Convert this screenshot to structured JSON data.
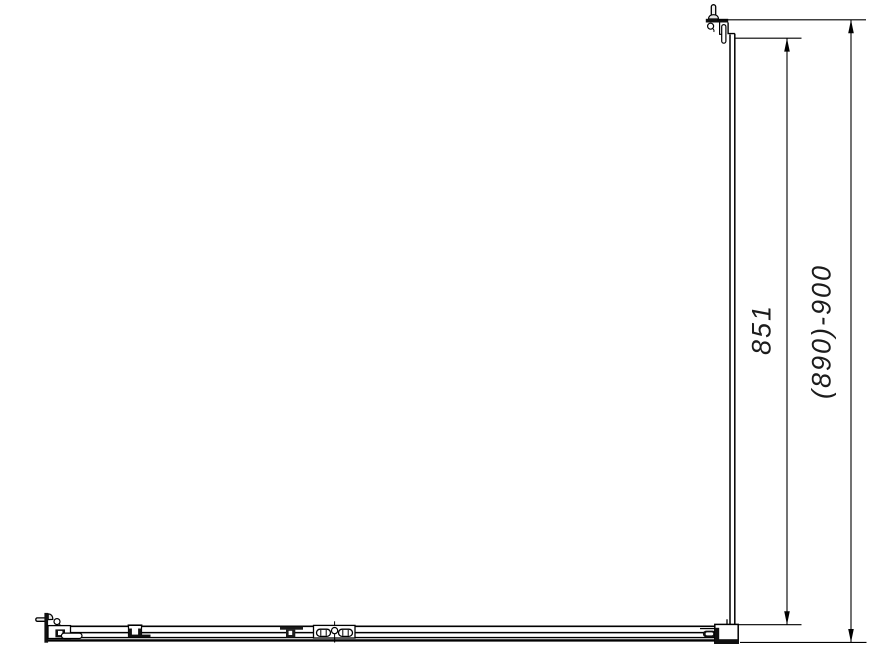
{
  "colors": {
    "background": "#ffffff",
    "line": "#000000"
  },
  "dimensions": {
    "inner": {
      "label": "851"
    },
    "outer": {
      "label": "(890)-900"
    }
  }
}
